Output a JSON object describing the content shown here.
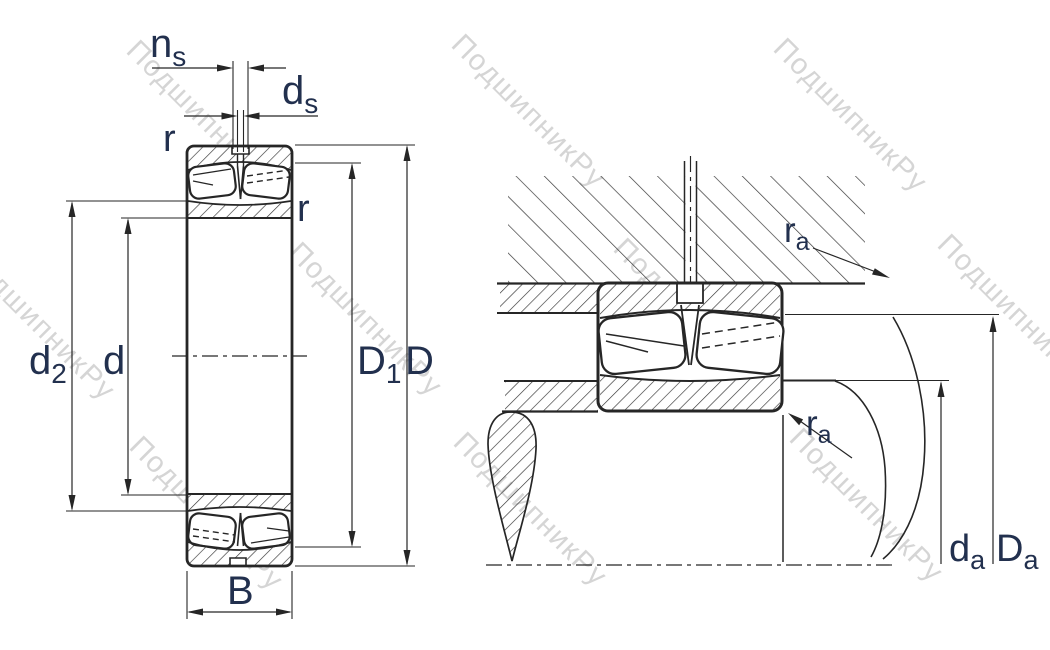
{
  "watermark": {
    "text": "ПодшипникРу"
  },
  "colors": {
    "line": "#262626",
    "label": "#22304e",
    "watermark": "#c5c5c5",
    "background": "#ffffff"
  },
  "left_view": {
    "labels": {
      "ns": {
        "base": "n",
        "sub": "s"
      },
      "ds": {
        "base": "d",
        "sub": "s"
      },
      "r_top": "r",
      "r_side": "r",
      "d2": {
        "base": "d",
        "sub": "2"
      },
      "d": "d",
      "D1": {
        "base": "D",
        "sub": "1"
      },
      "D": "D",
      "B": "B"
    }
  },
  "right_view": {
    "labels": {
      "ra_top": {
        "base": "r",
        "sub": "a"
      },
      "ra_bottom": {
        "base": "r",
        "sub": "a"
      },
      "da": {
        "base": "d",
        "sub": "a"
      },
      "Da": {
        "base": "D",
        "sub": "a"
      }
    }
  }
}
